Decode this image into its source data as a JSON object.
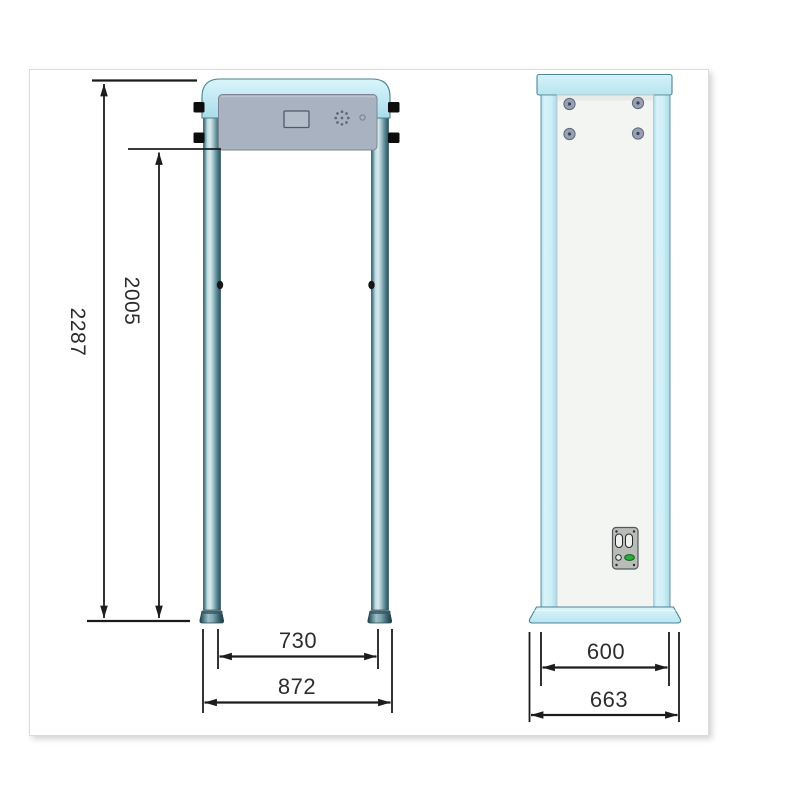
{
  "drawing": {
    "type": "technical-dimension-drawing",
    "subject": "walk-through metal detector gate, front and side views",
    "dims": {
      "overall_height": "2287",
      "inner_height": "2005",
      "inner_width": "730",
      "overall_width": "872",
      "body_depth": "600",
      "base_depth": "663"
    },
    "colors": {
      "frame_cyan": "#c8ecf4",
      "tube_teal": "#6f9dab",
      "panel_gray": "#a8b2c1",
      "side_panel_white": "#f3f5f2",
      "dimension_line": "#1c1c1c",
      "led_green": "#27b13c"
    }
  }
}
